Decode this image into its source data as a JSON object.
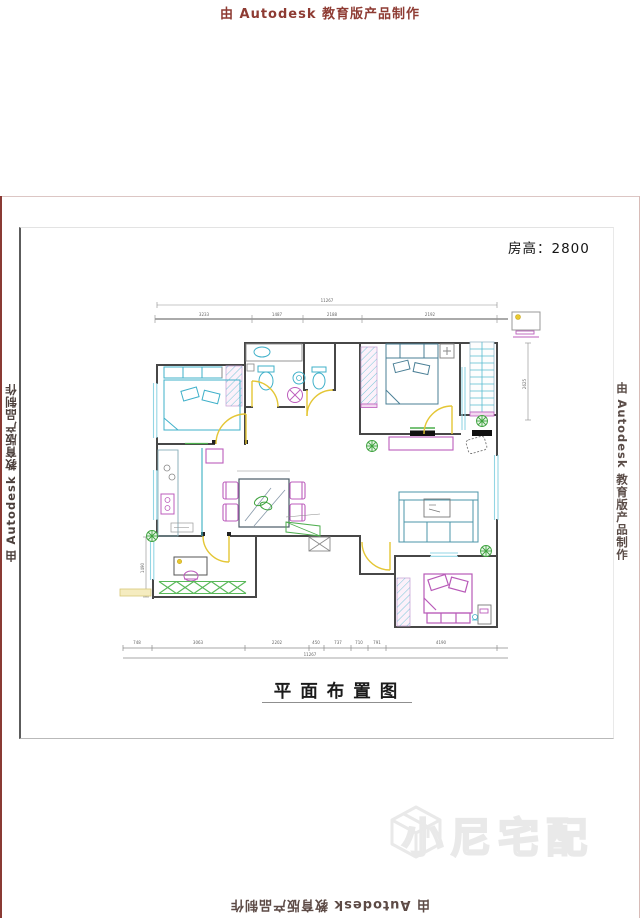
{
  "watermark": {
    "text": "由 Autodesk 教育版产品制作"
  },
  "labels": {
    "room_height": "房高：2800",
    "title": "平面布置图"
  },
  "brand": {
    "name": "小尼宅配"
  },
  "dims": {
    "top_total": "11267",
    "top_segments": [
      "3233",
      "1487",
      "2188",
      "2192"
    ],
    "right_height": "2625",
    "left_height": "1490",
    "bottom_segments": [
      "748",
      "3063",
      "2202",
      "450",
      "737",
      "710",
      "791",
      "4190"
    ],
    "bottom_total": "11267"
  },
  "colors": {
    "wall": "#474747",
    "furniture_cyan": "#3fb0c9",
    "window_cyan": "#93d6e4",
    "accent_magenta": "#bc5cbc",
    "door_yellow": "#e4c635",
    "plant_green": "#3fa33f",
    "watermark_red": "#8e3b33"
  }
}
